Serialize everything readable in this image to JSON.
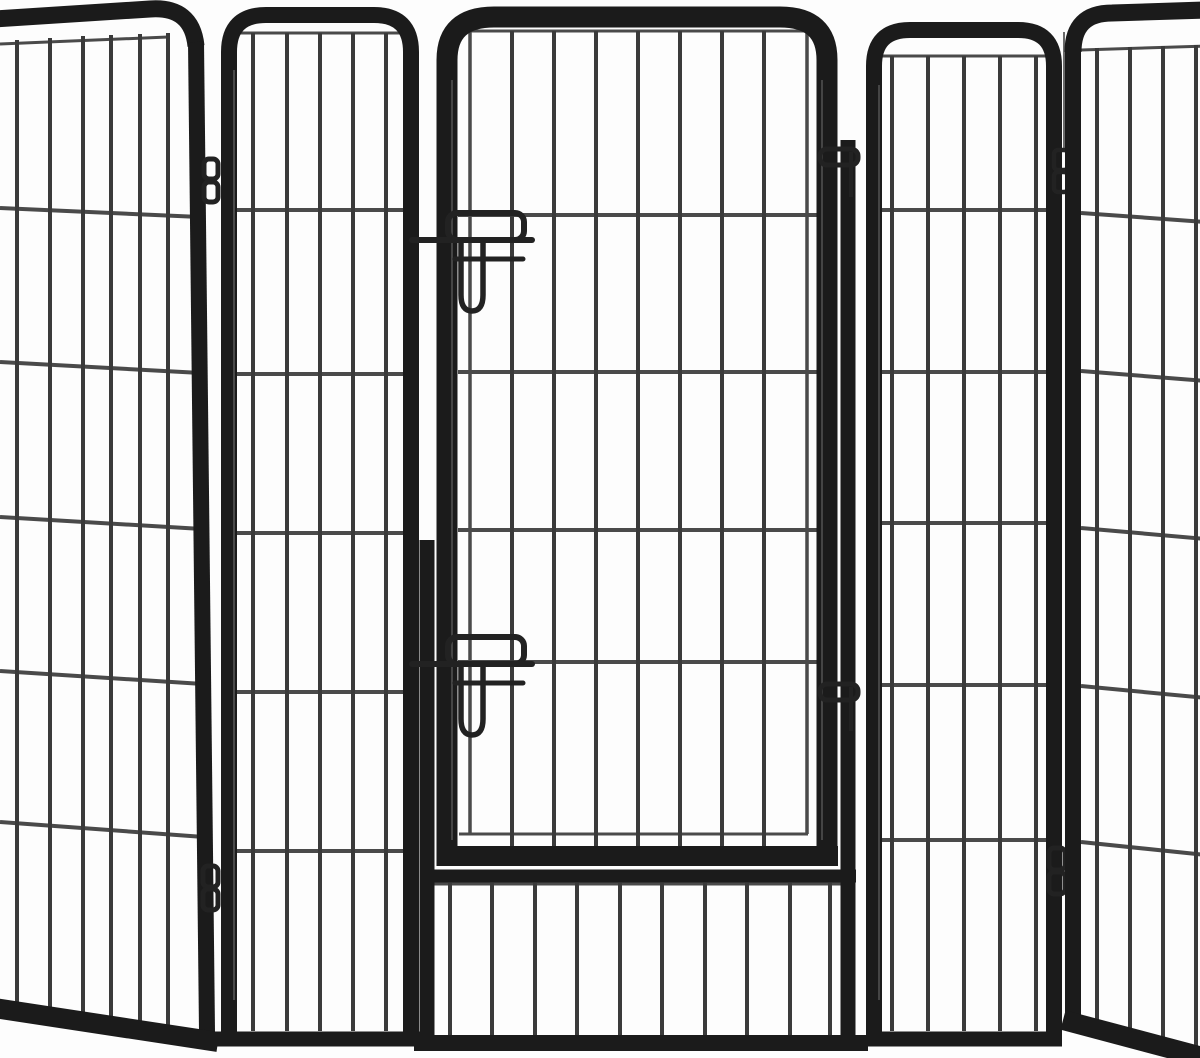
{
  "scene": {
    "type": "product-photo",
    "subject": "Heavy-duty black metal pet playpen / exercise fence, five visible panels arranged in a folded row, center panel with hinged gate",
    "image_width": 1200,
    "image_height": 1058
  },
  "colors": {
    "background": "#fdfdfd",
    "tube": "#1b1b1b",
    "bar": "#3a3a3a",
    "wire": "#4a4a4a",
    "hardware": "#222222",
    "pin": "#6a6a6a",
    "highlight": "#7a7a7a"
  },
  "playpen": {
    "panels": [
      {
        "id": "panel-1",
        "position": "far-left",
        "orientation": "angled-left, cut off by image edge",
        "vertical_bars": 6,
        "horizontal_wires": 5
      },
      {
        "id": "panel-2",
        "position": "left",
        "orientation": "front-facing, rounded-top frame",
        "vertical_bars": 5,
        "horizontal_wires": 5
      },
      {
        "id": "panel-3",
        "position": "center",
        "orientation": "front-facing gate panel",
        "vertical_bars": 10,
        "horizontal_wires": 4,
        "gate": {
          "shape": "rounded-top rectangular door",
          "vertical_bars": 9,
          "horizontal_wires": 4,
          "hinge_side": "right",
          "hinges": 2,
          "latches": [
            {
              "position": "upper",
              "parts": [
                "catch-bracket",
                "slide-bolt-rod",
                "guide-rod",
                "drop-handle"
              ]
            },
            {
              "position": "lower",
              "parts": [
                "catch-bracket",
                "slide-bolt-rod",
                "guide-rod",
                "drop-handle"
              ]
            }
          ]
        },
        "bottom_section_bars": 10
      },
      {
        "id": "panel-4",
        "position": "right",
        "orientation": "front-facing, rounded-top frame",
        "vertical_bars": 5,
        "horizontal_wires": 5
      },
      {
        "id": "panel-5",
        "position": "far-right",
        "orientation": "angled-right, cut off by image edge",
        "vertical_bars": 4,
        "horizontal_wires": 5
      }
    ],
    "joint_hinges": [
      {
        "between": "panel-1 and panel-2",
        "loop_count": 4
      },
      {
        "between": "gate and panel-3 frame",
        "loop_count": 2
      },
      {
        "between": "panel-4 and panel-5",
        "loop_count": 4
      }
    ]
  }
}
